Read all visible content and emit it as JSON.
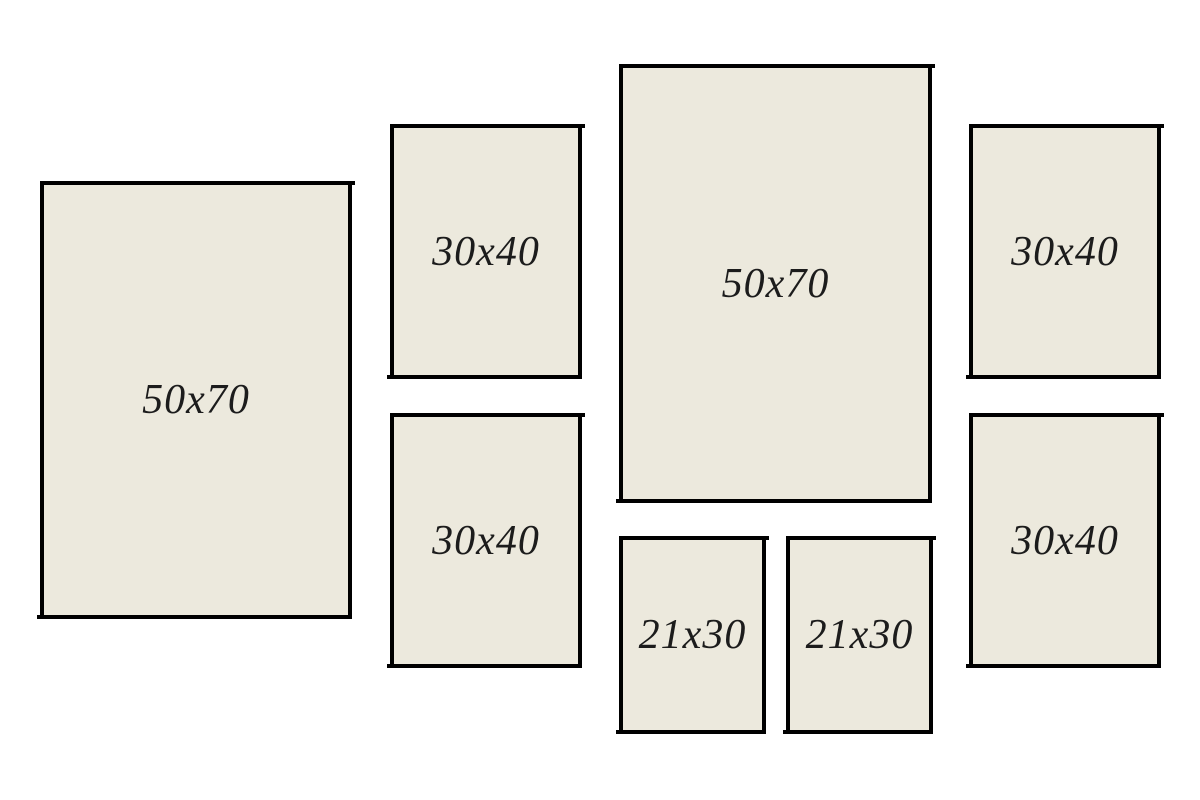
{
  "colors": {
    "background": "#ffffff",
    "frame_fill": "#ece9dd",
    "frame_border": "#000000",
    "label_text": "#1c1c1c"
  },
  "frames": [
    {
      "name": "frame-50x70-left",
      "label": "50x70"
    },
    {
      "name": "frame-30x40-middle-top",
      "label": "30x40"
    },
    {
      "name": "frame-30x40-middle-bottom",
      "label": "30x40"
    },
    {
      "name": "frame-50x70-center",
      "label": "50x70"
    },
    {
      "name": "frame-21x30-left",
      "label": "21x30"
    },
    {
      "name": "frame-21x30-right",
      "label": "21x30"
    },
    {
      "name": "frame-30x40-right-top",
      "label": "30x40"
    },
    {
      "name": "frame-30x40-right-bottom",
      "label": "30x40"
    }
  ]
}
